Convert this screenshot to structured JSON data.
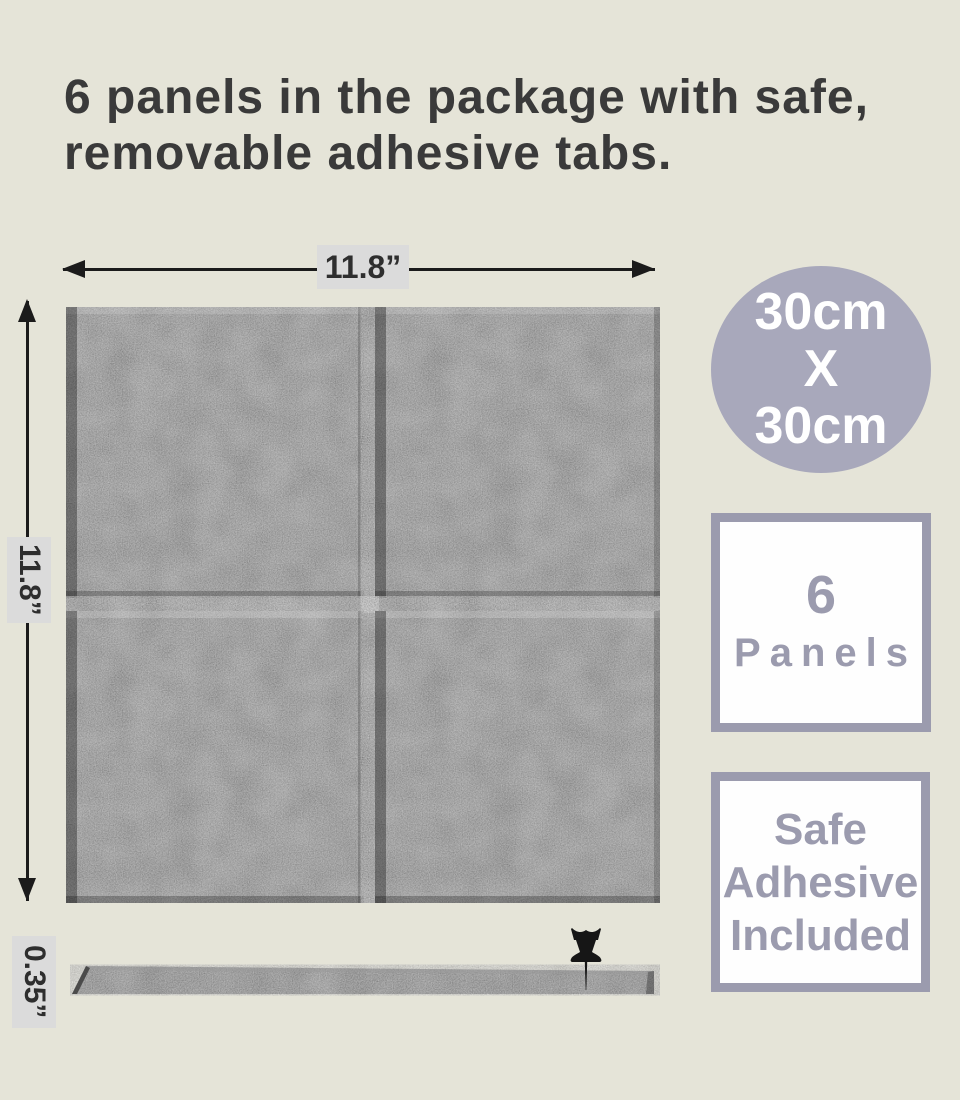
{
  "title": {
    "line1": "6 panels in the package with safe,",
    "line2": "removable adhesive tabs."
  },
  "diagram": {
    "width_label": "11.8”",
    "height_label": "11.8”",
    "thickness_label": "0.35”"
  },
  "badges": {
    "size_circle": {
      "line1": "30cm",
      "line2": "X",
      "line3": "30cm"
    },
    "panel_count": {
      "line1": "6",
      "line2": "Panels"
    },
    "adhesive": {
      "line1": "Safe",
      "line2": "Adhesive",
      "line3": "Included"
    }
  },
  "colors": {
    "background": "#e5e4d8",
    "accent_lavender": "#a8a8bb",
    "badge_border": "#9b9bae",
    "felt_gray": "#6d6d6d",
    "label_box_gray": "#dbdbdb",
    "title_text": "#3a3a3a",
    "dimension_line": "#1b1b1b"
  }
}
